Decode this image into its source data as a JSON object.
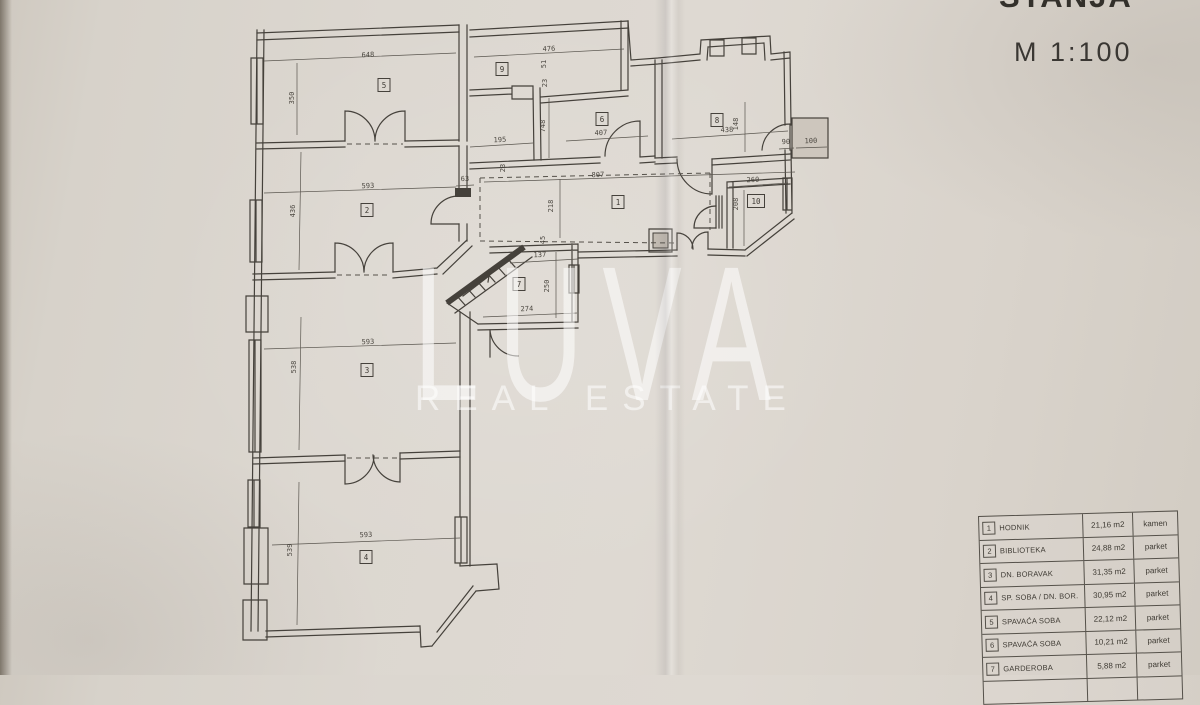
{
  "header": {
    "title_partial": "STANJA",
    "scale": "M 1:100"
  },
  "watermark": {
    "line1": "LUVA",
    "line2": "REAL ESTATE"
  },
  "colors": {
    "paper": "#d9d4cc",
    "ink": "#45413b",
    "watermark": "rgba(255,255,255,0.55)"
  },
  "plan": {
    "room_labels": [
      {
        "n": "5",
        "x": 384,
        "y": 85
      },
      {
        "n": "9",
        "x": 502,
        "y": 69
      },
      {
        "n": "6",
        "x": 602,
        "y": 119
      },
      {
        "n": "8",
        "x": 717,
        "y": 120
      },
      {
        "n": "1",
        "x": 618,
        "y": 202
      },
      {
        "n": "10",
        "x": 756,
        "y": 201
      },
      {
        "n": "2",
        "x": 367,
        "y": 210
      },
      {
        "n": "7",
        "x": 519,
        "y": 284
      },
      {
        "n": "3",
        "x": 367,
        "y": 370
      },
      {
        "n": "4",
        "x": 366,
        "y": 557
      }
    ],
    "dimensions": [
      {
        "t": "648",
        "x": 368,
        "y": 57,
        "r": -2
      },
      {
        "t": "350",
        "x": 294,
        "y": 98,
        "r": -90
      },
      {
        "t": "476",
        "x": 549,
        "y": 51,
        "r": -2
      },
      {
        "t": "51",
        "x": 546,
        "y": 64,
        "r": -90
      },
      {
        "t": "23",
        "x": 547,
        "y": 83,
        "r": -90
      },
      {
        "t": "748",
        "x": 545,
        "y": 126,
        "r": -90
      },
      {
        "t": "195",
        "x": 500,
        "y": 142,
        "r": -2
      },
      {
        "t": "407",
        "x": 601,
        "y": 135,
        "r": -2
      },
      {
        "t": "438",
        "x": 727,
        "y": 132,
        "r": -2
      },
      {
        "t": "148",
        "x": 738,
        "y": 124,
        "r": -90
      },
      {
        "t": "90",
        "x": 786,
        "y": 144,
        "r": -2
      },
      {
        "t": "100",
        "x": 811,
        "y": 143,
        "r": -2
      },
      {
        "t": "63",
        "x": 465,
        "y": 181,
        "r": -2
      },
      {
        "t": "23",
        "x": 505,
        "y": 168,
        "r": -90
      },
      {
        "t": "807",
        "x": 598,
        "y": 177,
        "r": -2
      },
      {
        "t": "218",
        "x": 553,
        "y": 206,
        "r": -90
      },
      {
        "t": "593",
        "x": 368,
        "y": 188,
        "r": -2
      },
      {
        "t": "436",
        "x": 295,
        "y": 211,
        "r": -90
      },
      {
        "t": "45",
        "x": 545,
        "y": 240,
        "r": -90
      },
      {
        "t": "137",
        "x": 540,
        "y": 257,
        "r": -2
      },
      {
        "t": "250",
        "x": 549,
        "y": 286,
        "r": -90
      },
      {
        "t": "274",
        "x": 527,
        "y": 311,
        "r": -2
      },
      {
        "t": "593",
        "x": 368,
        "y": 344,
        "r": -2
      },
      {
        "t": "538",
        "x": 296,
        "y": 367,
        "r": -90
      },
      {
        "t": "593",
        "x": 366,
        "y": 537,
        "r": -2
      },
      {
        "t": "539",
        "x": 292,
        "y": 550,
        "r": -90
      },
      {
        "t": "260",
        "x": 753,
        "y": 182,
        "r": -2
      },
      {
        "t": "208",
        "x": 738,
        "y": 204,
        "r": -90
      }
    ]
  },
  "legend": {
    "rows": [
      {
        "num": "1",
        "name": "HODNIK",
        "area": "21,16 m2",
        "floor": "kamen"
      },
      {
        "num": "2",
        "name": "BIBLIOTEKA",
        "area": "24,88 m2",
        "floor": "parket"
      },
      {
        "num": "3",
        "name": "DN. BORAVAK",
        "area": "31,35 m2",
        "floor": "parket"
      },
      {
        "num": "4",
        "name": "SP. SOBA / DN. BOR.",
        "area": "30,95 m2",
        "floor": "parket"
      },
      {
        "num": "5",
        "name": "SPAVAĆA SOBA",
        "area": "22,12 m2",
        "floor": "parket"
      },
      {
        "num": "6",
        "name": "SPAVAĆA SOBA",
        "area": "10,21 m2",
        "floor": "parket"
      },
      {
        "num": "7",
        "name": "GARDEROBA",
        "area": "5,88 m2",
        "floor": "parket"
      },
      {
        "num": "",
        "name": "",
        "area": "",
        "floor": ""
      }
    ]
  }
}
